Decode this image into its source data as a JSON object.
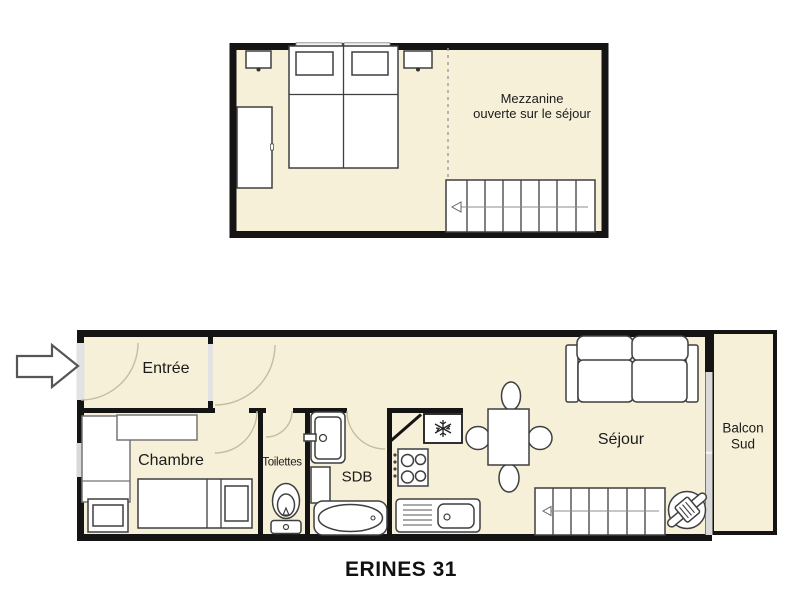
{
  "title": "ERINES 31",
  "palette": {
    "floor_fill": "#F7F0D8",
    "wall": "#141414",
    "window_glass": "#D9D9D9",
    "door_arc": "#C4BDA0",
    "furniture_stroke": "#3F3F3F"
  },
  "upper_floor": {
    "label_lines": [
      "Mezzanine",
      "ouverte sur le séjour"
    ],
    "furniture_icons": [
      "wardrobe-icon",
      "nightstand-icon",
      "double-bed-icon",
      "staircase-icon",
      "open-edge-dashed-line"
    ]
  },
  "lower_floor": {
    "rooms": {
      "entree": {
        "label": "Entrée"
      },
      "chambre": {
        "label": "Chambre"
      },
      "toilettes": {
        "label": "Toilettes"
      },
      "sdb": {
        "label": "SDB"
      },
      "sejour": {
        "label": "Séjour"
      },
      "balcon": {
        "label_lines": [
          "Balcon",
          "Sud"
        ]
      }
    },
    "furniture_icons": [
      "entrance-arrow-icon",
      "single-bed-icon",
      "nightstand-icon",
      "dresser-icon",
      "toilet-icon",
      "washbasin-icon",
      "bathtub-icon",
      "fridge-snowflake-icon",
      "stove-icon",
      "kitchen-sink-icon",
      "dining-table-icon",
      "chair-icon",
      "sofa-icon",
      "staircase-icon",
      "water-heater-icon",
      "door-arc-icon",
      "window-icon"
    ]
  }
}
